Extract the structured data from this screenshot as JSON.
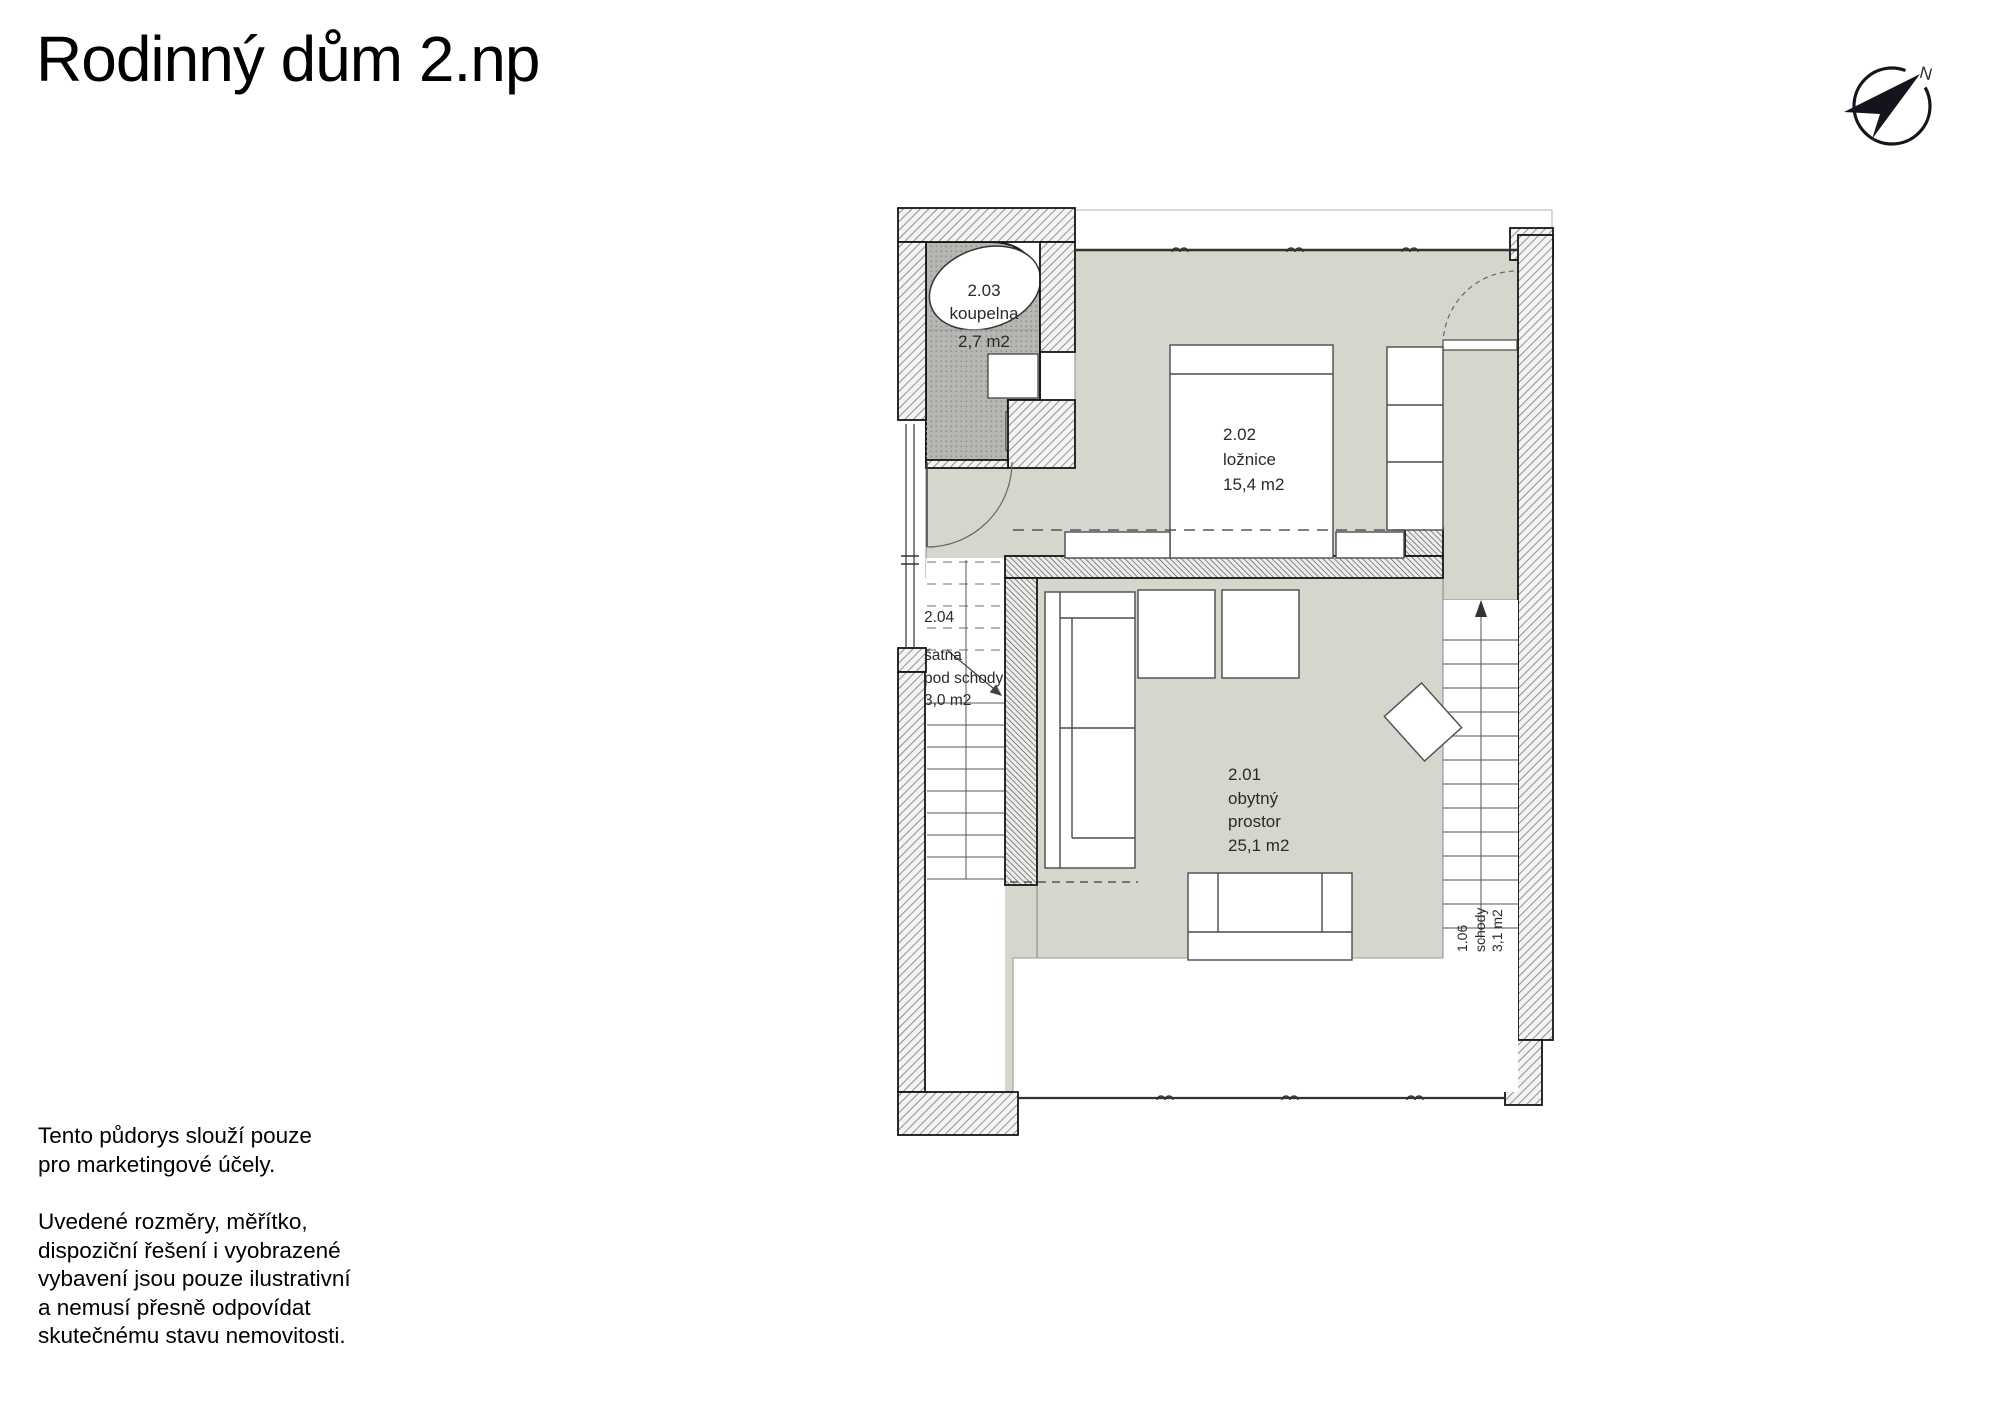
{
  "header": {
    "title": "Rodinný dům 2.np"
  },
  "compass": {
    "north_label": "N"
  },
  "floorplan": {
    "rooms": {
      "bathroom": {
        "id": "2.03",
        "name": "koupelna",
        "area": "2,7 m2"
      },
      "bedroom": {
        "id": "2.02",
        "name": "ložnice",
        "area": "15,4 m2"
      },
      "closet": {
        "id": "2.04",
        "name_line1": "šatna",
        "name_line2": "pod schody",
        "area": "3,0 m2"
      },
      "living": {
        "id": "2.01",
        "name_line1": "obytný",
        "name_line2": "prostor",
        "area": "25,1 m2"
      },
      "stairs": {
        "id": "1.06",
        "name": "schody",
        "area": "3,1 m2"
      }
    }
  },
  "disclaimer": {
    "paragraph1": [
      "Tento půdorys slouží pouze",
      "pro marketingové účely."
    ],
    "paragraph2": [
      "Uvedené rozměry, měřítko,",
      "dispoziční řešení i vyobrazené",
      "vybavení jsou pouze ilustrativní",
      "a nemusí přesně odpovídat",
      "skutečnému stavu nemovitosti."
    ]
  }
}
